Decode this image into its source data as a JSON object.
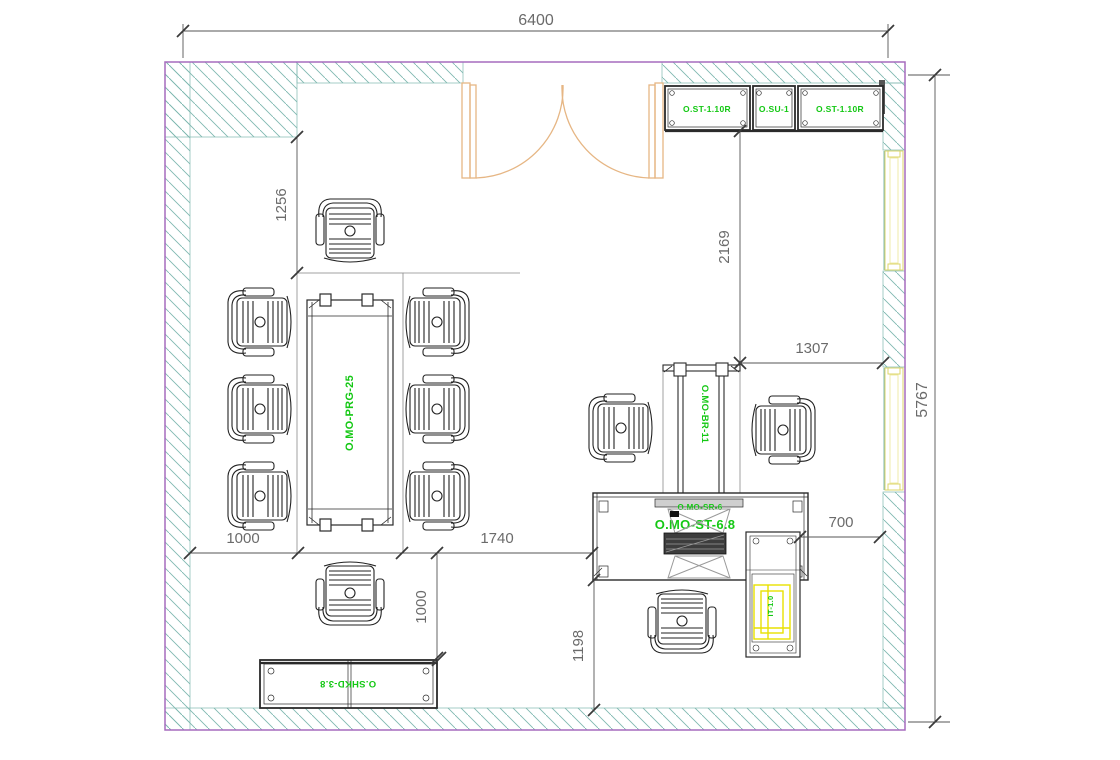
{
  "drawing": {
    "title": "office-floor-plan",
    "dims": {
      "width_top": "6400",
      "height_right": "5767",
      "left_gap": "1256",
      "door_to_desk": "2169",
      "desk_to_wall": "1307",
      "chair_gap": "1000",
      "table_to_desk": "1740",
      "cabinet_gap": "1000",
      "desk_to_bottom": "1198",
      "desk_to_right": "700"
    },
    "labels": {
      "cabinet_left": "O.ST-1.10R",
      "cabinet_center": "O.SU-1",
      "cabinet_right": "O.ST-1.10R",
      "conference_table": "O.MO-PRG-25",
      "meeting_table": "O.MO-BR-11",
      "desk_top": "O.MO-SR-6",
      "desk_main": "O.MO-ST-6.8",
      "storage": "O.SHKD-3.8",
      "it_unit": "IT-1.0"
    },
    "colors": {
      "wall_outline": "#A66BBE",
      "hatch": "#7FB8B0",
      "label_green": "#14C814",
      "door": "#E6B684",
      "window": "#DCD66A",
      "highlight_yellow": "#E8E000",
      "dimension": "#6B6B6B",
      "furniture": "#2A2A2A"
    }
  }
}
